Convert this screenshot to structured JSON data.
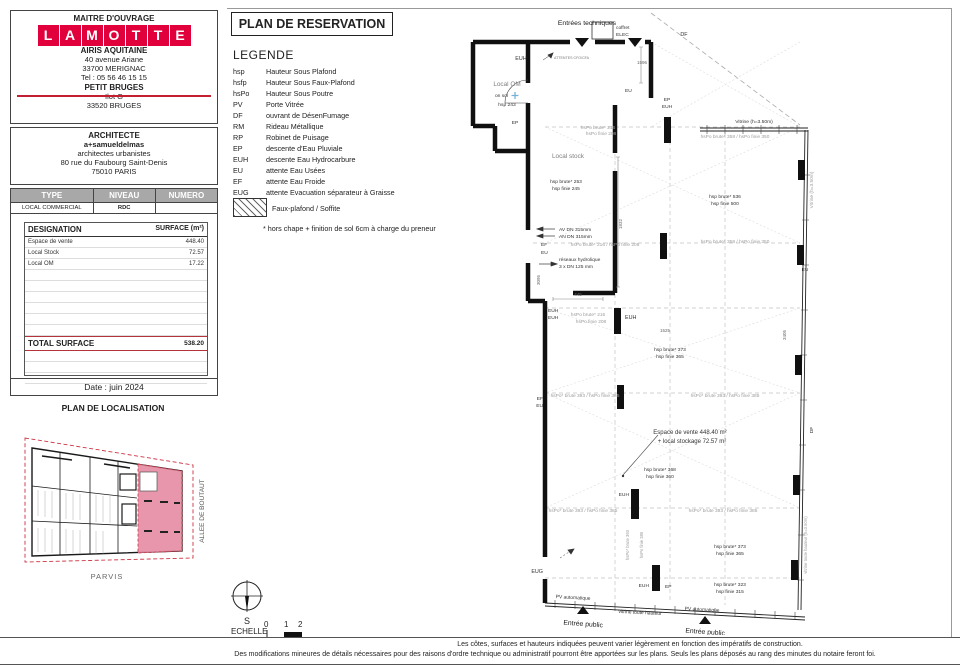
{
  "colors": {
    "logo_red": "#e2003c",
    "highlight_pink": "#e58ba2",
    "total_line_red": "#b5343c"
  },
  "sheet": {
    "maitre": {
      "heading": "MAITRE D'OUVRAGE",
      "logo_letters": [
        "L",
        "A",
        "M",
        "O",
        "T",
        "T",
        "E"
      ],
      "company": "AIRIS AQUITAINE",
      "address1": "40 avenue Ariane",
      "address2": "33700 MERIGNAC",
      "tel": "Tel : 05 56 46 15 15",
      "project": "PETIT BRUGES",
      "ilot": "Ilot G",
      "city": "33520 BRUGES"
    },
    "architecte": {
      "heading": "ARCHITECTE",
      "name": "a+samueldelmas",
      "line2": "architectes urbanistes",
      "line3": "80 rue du Faubourg Saint-Denis",
      "line4": "75010 PARIS"
    },
    "type_table": {
      "headers": [
        "TYPE",
        "NIVEAU",
        "NUMERO"
      ],
      "row": [
        "LOCAL COMMERCIAL",
        "RDC",
        ""
      ]
    },
    "surface_table": {
      "col1": "DESIGNATION",
      "col2": "SURFACE (m²)",
      "rows": [
        {
          "label": "Espace de vente",
          "value": "448.40"
        },
        {
          "label": "Local Stock",
          "value": "72.57"
        },
        {
          "label": "Local OM",
          "value": "17.22"
        }
      ],
      "total_label": "TOTAL SURFACE",
      "total_value": "538.20"
    },
    "date": "Date : juin 2024"
  },
  "localisation": {
    "title": "PLAN DE LOCALISATION",
    "street_label": "ALLEE DE BOUTAUT",
    "bottom_label": "PARVIS"
  },
  "reservation": {
    "title": "PLAN DE RESERVATION"
  },
  "legend": {
    "heading": "LEGENDE",
    "items": [
      {
        "abbr": "hsp",
        "label": "Hauteur Sous Plafond"
      },
      {
        "abbr": "hsfp",
        "label": "Hauteur Sous Faux-Plafond"
      },
      {
        "abbr": "hsPo",
        "label": "Hauteur Sous Poutre"
      },
      {
        "abbr": "PV",
        "label": "Porte Vitrée"
      },
      {
        "abbr": "DF",
        "label": "ouvrant de DésenFumage"
      },
      {
        "abbr": "RM",
        "label": "Rideau Métallique"
      },
      {
        "abbr": "RP",
        "label": "Robinet de Puisage"
      },
      {
        "abbr": "EP",
        "label": "descente d'Eau Pluviale"
      },
      {
        "abbr": "EUH",
        "label": "descente Eau Hydrocarbure"
      },
      {
        "abbr": "EU",
        "label": "attente Eau Usées"
      },
      {
        "abbr": "EF",
        "label": "attente Eau Froide"
      },
      {
        "abbr": "EUG",
        "label": "attente Evacuation séparateur à Graisse"
      }
    ],
    "hatch_label": "Faux-plafond / Soffite",
    "note": "* hors chape + finition de sol 6cm à charge du preneur"
  },
  "plan_labels": {
    "entrees": "Entrées techniques",
    "coffret1": "coffret",
    "coffret2": "ELEC",
    "df_top": "DF",
    "vitrine_top": "Vitrine (h=3.50m)",
    "euh_top": "EUH",
    "attentes": "ATTENTES CFO/CFA",
    "local_om": "Local OM",
    "on_sol": "on sol",
    "hsp243": "hsp 243",
    "ep_om": "EP",
    "d1596": "1596",
    "eu_top": "EU",
    "hsPo216_a1": "hsPo brute* 216",
    "hsPo216_a2": "hsPo finie 208",
    "hsPo358_a": "hsPo brute* 358 / hsPo finie 350",
    "ep_c": "EP",
    "euh_c": "EUH",
    "local_stock": "Local stock",
    "hsp253": "hsp brute* 253",
    "hsp245": "hsp finie 245",
    "d1832": "1832",
    "hsp536": "hsp brute* 536",
    "hsp500": "hsp finie 500",
    "av_dn": "AV DN 315mm",
    "an_dn": "AN DN 315mm",
    "ef_a": "EF",
    "eu_a": "EU",
    "reseaux": "réseaux hydrolique",
    "dn125": "3 x DN 125 mm",
    "hsPo216_b": "hsPo brute* 216 / hsPo finie 208",
    "hsPo358_b": "hsPo brute* 358 / hsPo finie 350",
    "eu_edge": "EU",
    "vitrine_right": "Vitrine (h=3.50m)",
    "d445": "445",
    "euh_l1": "EUH",
    "euh_l2": "EUH",
    "d3095": "3095",
    "hsPo216_c1": "hsPo brute* 216",
    "hsPo216_c2": "hsPo finie 208",
    "euh_m": "EUH",
    "d1525": "1525",
    "d3405": "3405",
    "hsp373_a1": "hsp brute* 373",
    "hsp373_a2": "hsp finie 365",
    "ef_b": "EF",
    "eu_b": "EU",
    "hsPo393_a": "hsPo* brute 393 / hsPo finie 385",
    "hsPo393_b": "hsPo* brute 393 / hsPo finie 385",
    "espace1": "Espace de vente 448.40 m²",
    "espace2": "+ local stockage 72.57 m²",
    "hsp368_1": "hsp brute* 368",
    "hsp368_2": "hsp finie 360",
    "euh_col": "EUH",
    "hsPo393_c": "hsPo* brute 393 / hsPo finie 385",
    "hsPo393_d": "hsPo* brute 393 / hsPo finie 385",
    "colv1": "hsPo* brute 393",
    "colv2": "hsPo finie 385",
    "df_right": "DF",
    "hsp373_b1": "hsp brute* 373",
    "hsp373_b2": "hsp finie 365",
    "hsp323_1": "hsp brute* 323",
    "hsp323_2": "hsp finie 315",
    "vitrine_low": "vitrine toute hauteur (h=3.50m)",
    "eug": "EUG",
    "euh_bot": "EUH",
    "ep_bot": "EP",
    "pv1": "PV automatique",
    "pv2": "PV automatique",
    "entree1": "Entrée public",
    "entree2": "Entrée public",
    "vitrine_bottom": "vitrine toute hauteur"
  },
  "footer": {
    "echelle_label": "ECHELLE",
    "scale_ticks": [
      "0",
      "1",
      "2"
    ],
    "compass_s": "S",
    "disclaimer1": "Les côtes, surfaces et hauteurs indiquées peuvent varier légèrement en fonction des impératifs de construction.",
    "disclaimer2": "Des modifications mineures de détails nécessaires pour des raisons d'ordre technique ou administratif pourront être apportées sur les plans. Seuls les plans déposés au rang des minutes du notaire feront foi."
  }
}
